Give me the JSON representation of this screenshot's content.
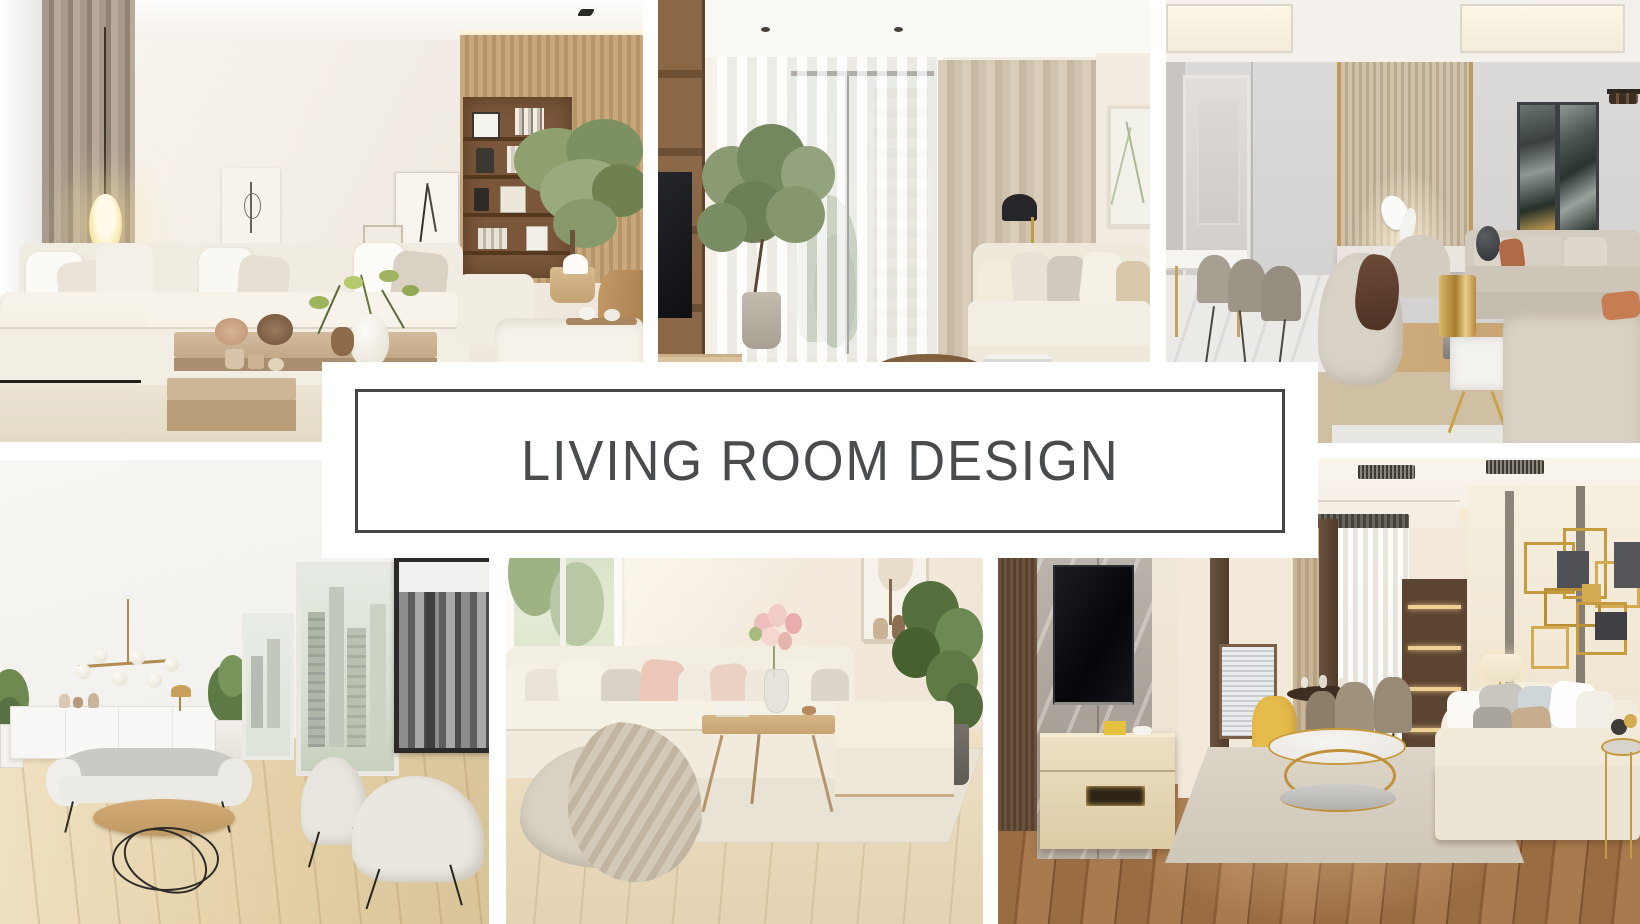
{
  "banner": {
    "title": "LIVING ROOM DESIGN",
    "background": "#ffffff",
    "border_color": "#46464a",
    "text_color": "#4a4b4d"
  },
  "canvas": {
    "background": "#ffffff"
  },
  "photos": [
    {
      "id": "top-left",
      "alt": "Modern beige living room with cream sectional sofa, glowing oval pendant lamp, taupe drapes, wood shelving nook with books and a leafy indoor tree"
    },
    {
      "id": "top-middle",
      "alt": "Living room with sheer window curtains, tall potted ficus tree, wood TV cabinet, beige drapes, cream sofa and round dark wood coffee table"
    },
    {
      "id": "top-right",
      "alt": "Luxury greige living and dining room with fluted feature wall, white horse sculpture, dark abstract art panels, curved armchairs, brass lamp and marble side table"
    },
    {
      "id": "bottom-left",
      "alt": "Bright apartment with wood dining table, brass globe chandelier, white sideboard, city-view windows, black and white skyline art, gray sofa and two cream armchairs"
    },
    {
      "id": "bottom-middle",
      "alt": "Cozy cream living room with sectional sofa, blush pillows, flowers on a wood coffee table, chunky knit pouf with throw blanket and a leafy plant"
    },
    {
      "id": "bottom-right",
      "alt": "Warm contemporary living room with marble TV wall, mounted TV, gold geometric wall art, white sofa with pillows, round gold coffee table and yellow dining chair"
    }
  ]
}
